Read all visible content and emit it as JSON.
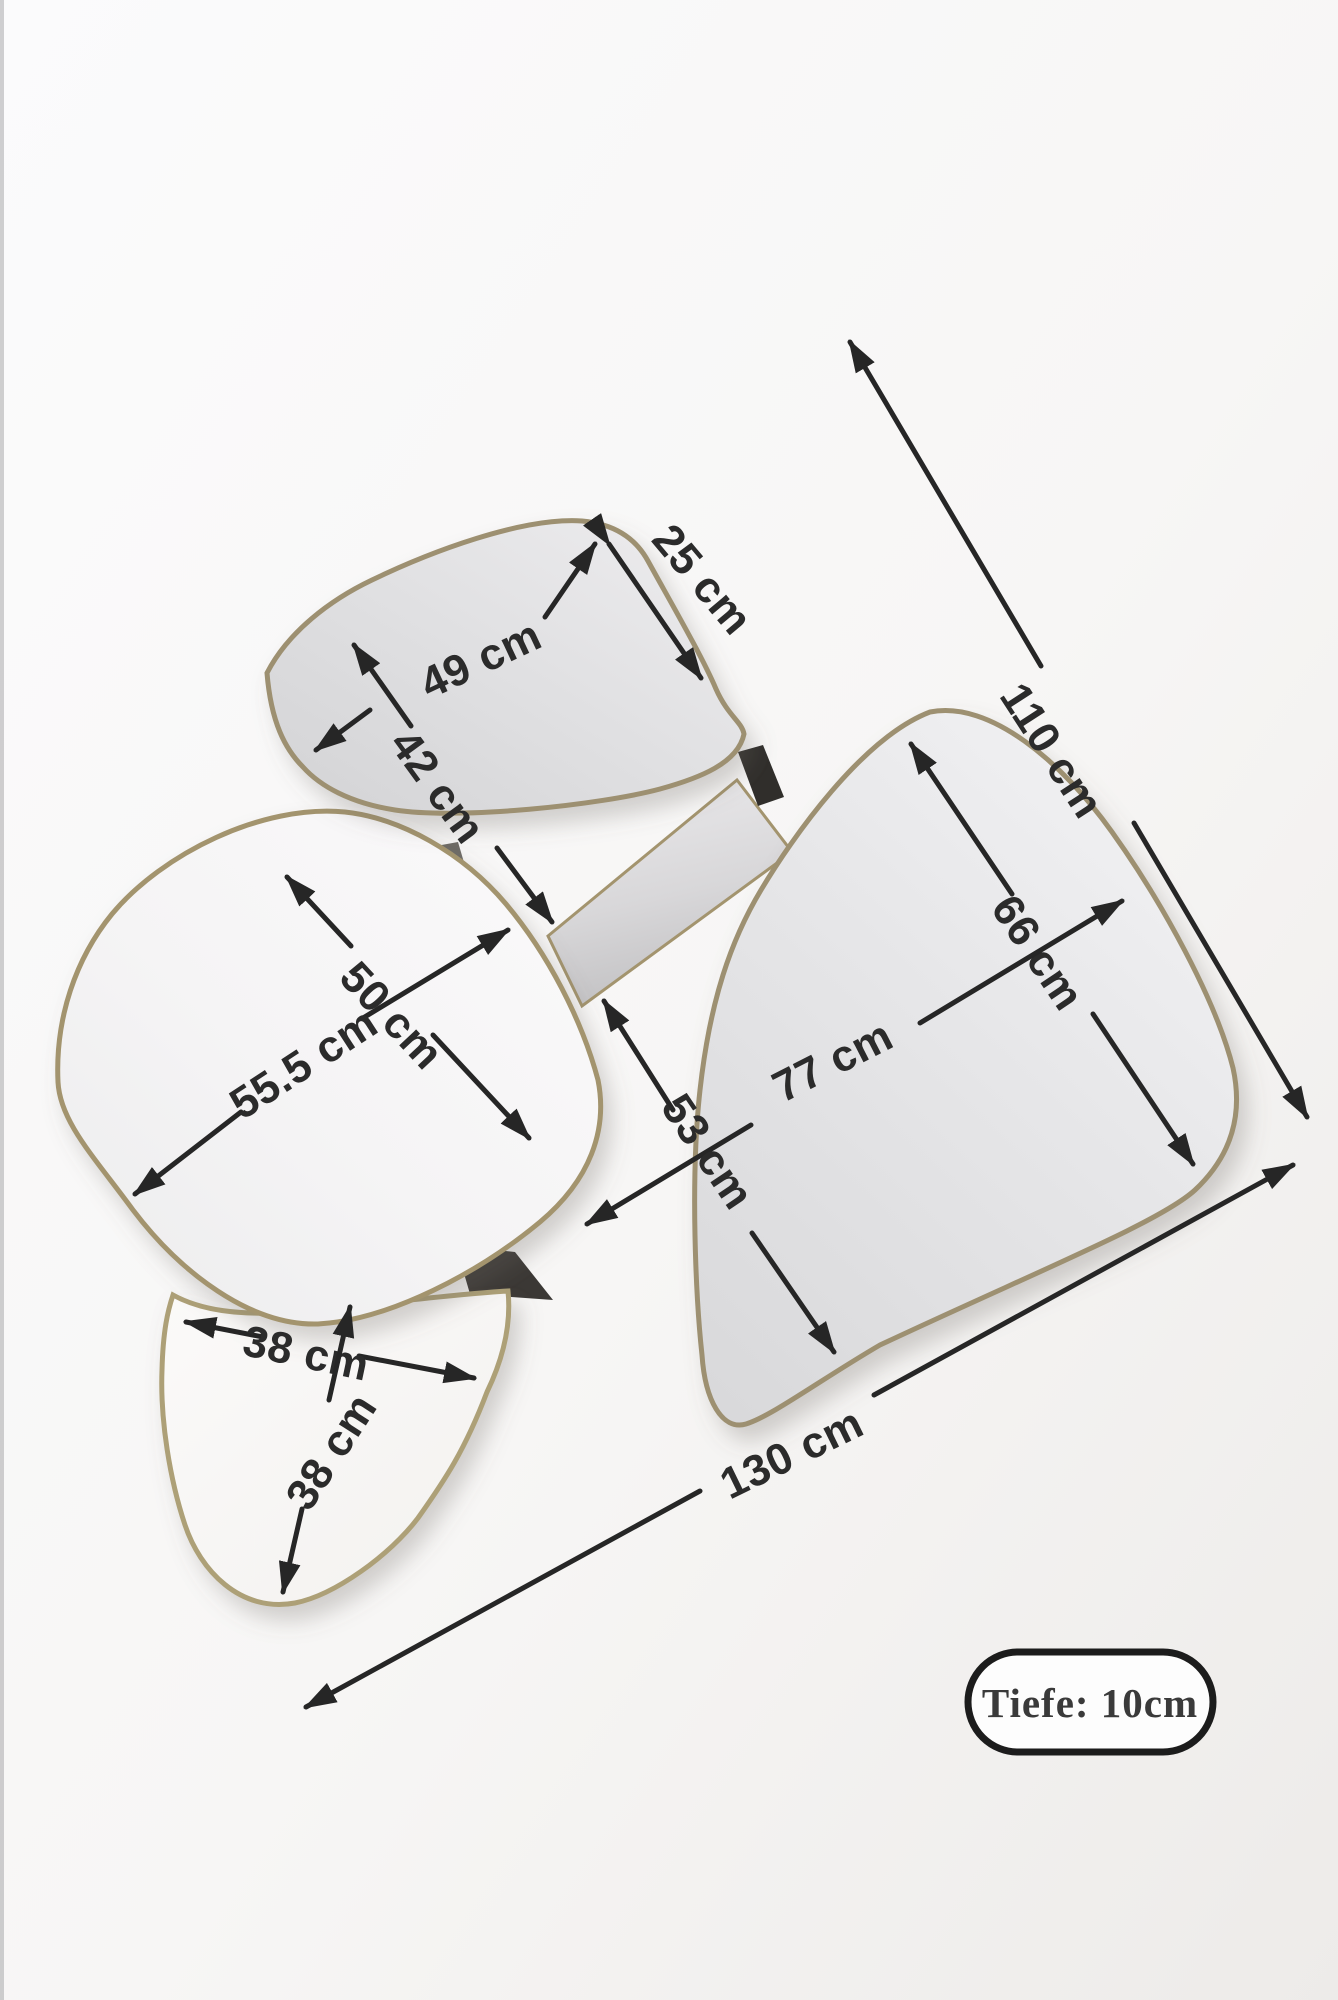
{
  "diagram": {
    "kind": "product-dimension-diagram",
    "subject": "wall mirror composition of four organic-shaped mirrors with brass frames and dimension arrows"
  },
  "dimensions": [
    {
      "id": "top-mirror-corner-width",
      "label": "25 cm"
    },
    {
      "id": "top-mirror-width",
      "label": "49 cm"
    },
    {
      "id": "top-mirror-height",
      "label": "42 cm"
    },
    {
      "id": "overall-height",
      "label": "110 cm"
    },
    {
      "id": "right-mirror-height",
      "label": "66 cm"
    },
    {
      "id": "right-mirror-width",
      "label": "77 cm"
    },
    {
      "id": "right-mirror-lower-width",
      "label": "53 cm"
    },
    {
      "id": "left-mirror-height",
      "label": "50 cm"
    },
    {
      "id": "left-mirror-width",
      "label": "55.5 cm"
    },
    {
      "id": "bottom-mirror-width",
      "label": "38 cm"
    },
    {
      "id": "bottom-mirror-height",
      "label": "38 cm"
    },
    {
      "id": "overall-width",
      "label": "130 cm"
    }
  ],
  "badge": {
    "label": "Tiefe: 10cm"
  },
  "colors": {
    "background": "#fafafa",
    "arrow": "#262626",
    "label_text": "#2b2b2b",
    "frame_brass": "#9d9071",
    "mirror_glass_gray": "#dcdcde",
    "mirror_glass_light": "#f4f3f4",
    "connector_dark": "#302e2b",
    "badge_border": "#1c1c1c",
    "badge_fill": "#fdfdfd"
  }
}
